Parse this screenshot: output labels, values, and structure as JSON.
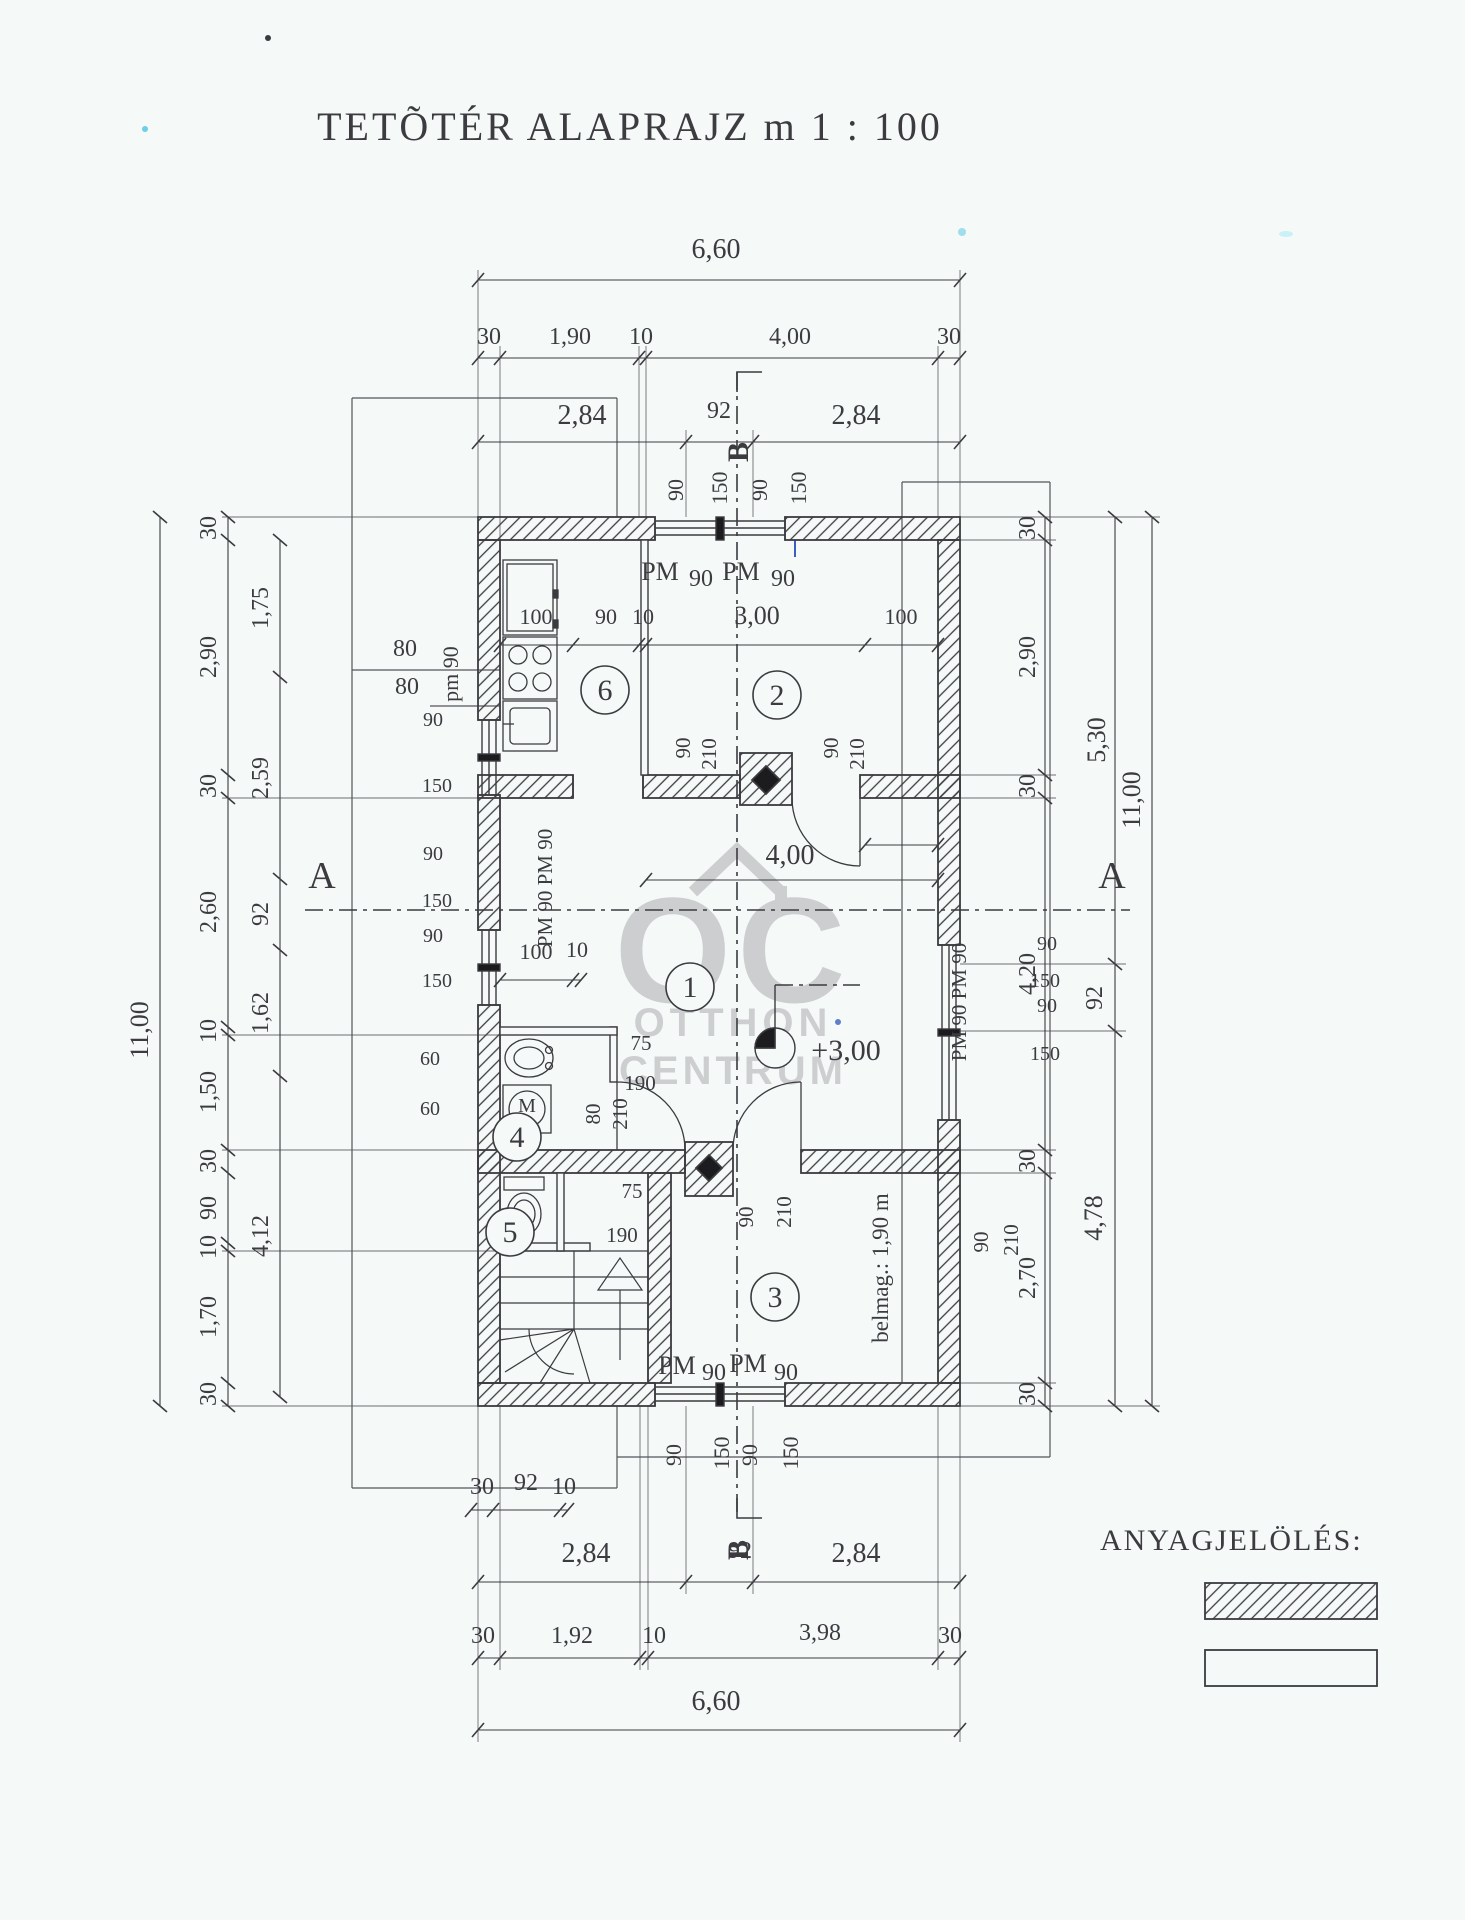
{
  "title": "TETÕTÉR ALAPRAJZ m 1 : 100",
  "legend": {
    "heading": "ANYAGJELÖLÉS:"
  },
  "watermark": {
    "logo": "OC",
    "line1": "OTTHON",
    "line2": "CENTRUM"
  },
  "colors": {
    "ink": "#3b3b40",
    "paper": "#f5f9f8",
    "thin": "#55555a",
    "watermark": "#bcbdc0",
    "blue": "#3a5fc0",
    "cyan": "#49c4e2"
  },
  "scale_text": "m 1 : 100",
  "rooms": [
    {
      "n": "6",
      "x": 605,
      "y": 690
    },
    {
      "n": "2",
      "x": 777,
      "y": 695
    },
    {
      "n": "1",
      "x": 690,
      "y": 987
    },
    {
      "n": "4",
      "x": 517,
      "y": 1137
    },
    {
      "n": "5",
      "x": 510,
      "y": 1232
    },
    {
      "n": "3",
      "x": 775,
      "y": 1297
    }
  ],
  "labels": [
    {
      "t": "6,60",
      "x": 716,
      "y": 258,
      "s": 28
    },
    {
      "t": "30",
      "x": 489,
      "y": 344
    },
    {
      "t": "1,90",
      "x": 570,
      "y": 344
    },
    {
      "t": "10",
      "x": 641,
      "y": 344
    },
    {
      "t": "4,00",
      "x": 790,
      "y": 344
    },
    {
      "t": "30",
      "x": 949,
      "y": 344
    },
    {
      "t": "2,84",
      "x": 582,
      "y": 424,
      "s": 28
    },
    {
      "t": "92",
      "x": 719,
      "y": 418
    },
    {
      "t": "2,84",
      "x": 856,
      "y": 424,
      "s": 28
    },
    {
      "t": "B",
      "x": 748,
      "y": 452,
      "r": -90,
      "s": 30,
      "b": 1
    },
    {
      "t": "90",
      "x": 683,
      "y": 490,
      "r": -90,
      "s": 22
    },
    {
      "t": "150",
      "x": 727,
      "y": 488,
      "r": -90,
      "s": 22
    },
    {
      "t": "90",
      "x": 767,
      "y": 490,
      "r": -90,
      "s": 22
    },
    {
      "t": "150",
      "x": 806,
      "y": 488,
      "r": -90,
      "s": 22
    },
    {
      "t": "PM",
      "x": 660,
      "y": 580,
      "s": 26
    },
    {
      "t": "90",
      "x": 701,
      "y": 586
    },
    {
      "t": "PM",
      "x": 741,
      "y": 580,
      "s": 26
    },
    {
      "t": "90",
      "x": 783,
      "y": 586
    },
    {
      "t": "80",
      "x": 405,
      "y": 656
    },
    {
      "t": "80",
      "x": 407,
      "y": 694
    },
    {
      "t": "pm 90",
      "x": 458,
      "y": 674,
      "r": -90,
      "s": 22
    },
    {
      "t": "100",
      "x": 536,
      "y": 624,
      "s": 22
    },
    {
      "t": "90",
      "x": 606,
      "y": 624,
      "s": 22
    },
    {
      "t": "10",
      "x": 643,
      "y": 624,
      "s": 22
    },
    {
      "t": "3,00",
      "x": 757,
      "y": 624,
      "s": 26
    },
    {
      "t": "100",
      "x": 901,
      "y": 624,
      "s": 22
    },
    {
      "t": "11,00",
      "x": 148,
      "y": 1030,
      "r": -90,
      "s": 26
    },
    {
      "t": "30",
      "x": 216,
      "y": 528,
      "r": -90
    },
    {
      "t": "2,90",
      "x": 216,
      "y": 657,
      "r": -90
    },
    {
      "t": "30",
      "x": 216,
      "y": 786,
      "r": -90
    },
    {
      "t": "2,60",
      "x": 216,
      "y": 912,
      "r": -90
    },
    {
      "t": "10",
      "x": 216,
      "y": 1031,
      "r": -90
    },
    {
      "t": "1,50",
      "x": 216,
      "y": 1092,
      "r": -90
    },
    {
      "t": "30",
      "x": 216,
      "y": 1161,
      "r": -90
    },
    {
      "t": "90",
      "x": 216,
      "y": 1208,
      "r": -90
    },
    {
      "t": "10",
      "x": 216,
      "y": 1247,
      "r": -90
    },
    {
      "t": "1,70",
      "x": 216,
      "y": 1317,
      "r": -90
    },
    {
      "t": "30",
      "x": 216,
      "y": 1394,
      "r": -90
    },
    {
      "t": "1,75",
      "x": 268,
      "y": 608,
      "r": -90
    },
    {
      "t": "2,59",
      "x": 268,
      "y": 778,
      "r": -90
    },
    {
      "t": "92",
      "x": 268,
      "y": 914,
      "r": -90
    },
    {
      "t": "1,62",
      "x": 268,
      "y": 1013,
      "r": -90
    },
    {
      "t": "4,12",
      "x": 268,
      "y": 1236,
      "r": -90
    },
    {
      "t": "90",
      "x": 433,
      "y": 726,
      "s": 20
    },
    {
      "t": "150",
      "x": 437,
      "y": 792,
      "s": 20
    },
    {
      "t": "90",
      "x": 433,
      "y": 860,
      "s": 20
    },
    {
      "t": "150",
      "x": 437,
      "y": 907,
      "s": 20
    },
    {
      "t": "90",
      "x": 433,
      "y": 942,
      "s": 20
    },
    {
      "t": "150",
      "x": 437,
      "y": 987,
      "s": 20
    },
    {
      "t": "60",
      "x": 430,
      "y": 1065,
      "s": 20
    },
    {
      "t": "60",
      "x": 430,
      "y": 1115,
      "s": 20
    },
    {
      "t": "PM 90 PM 90",
      "x": 552,
      "y": 888,
      "r": -90,
      "s": 21
    },
    {
      "t": "100",
      "x": 536,
      "y": 959,
      "s": 22
    },
    {
      "t": "10",
      "x": 577,
      "y": 957,
      "s": 22
    },
    {
      "t": "A",
      "x": 322,
      "y": 888,
      "s": 38
    },
    {
      "t": "A",
      "x": 1112,
      "y": 888,
      "s": 38
    },
    {
      "t": "4,00",
      "x": 790,
      "y": 864,
      "s": 28
    },
    {
      "t": "90",
      "x": 690,
      "y": 748,
      "r": -90,
      "s": 21
    },
    {
      "t": "210",
      "x": 716,
      "y": 754,
      "r": -90,
      "s": 21
    },
    {
      "t": "90",
      "x": 838,
      "y": 748,
      "r": -90,
      "s": 21
    },
    {
      "t": "210",
      "x": 864,
      "y": 754,
      "r": -90,
      "s": 21
    },
    {
      "t": "+3,00",
      "x": 846,
      "y": 1060,
      "s": 30
    },
    {
      "t": "75",
      "x": 641,
      "y": 1050,
      "s": 21
    },
    {
      "t": "190",
      "x": 640,
      "y": 1090,
      "s": 21
    },
    {
      "t": "80",
      "x": 600,
      "y": 1114,
      "r": -90,
      "s": 21
    },
    {
      "t": "210",
      "x": 627,
      "y": 1114,
      "r": -90,
      "s": 21
    },
    {
      "t": "90",
      "x": 753,
      "y": 1217,
      "r": -90,
      "s": 21
    },
    {
      "t": "210",
      "x": 791,
      "y": 1212,
      "r": -90,
      "s": 21
    },
    {
      "t": "75",
      "x": 632,
      "y": 1198,
      "s": 21
    },
    {
      "t": "190",
      "x": 622,
      "y": 1242,
      "s": 21
    },
    {
      "t": "M",
      "x": 527,
      "y": 1112,
      "s": 20
    },
    {
      "t": "belmag.: 1,90 m",
      "x": 888,
      "y": 1268,
      "r": -90,
      "s": 23
    },
    {
      "t": "PM 90 PM 90",
      "x": 966,
      "y": 1002,
      "r": -90,
      "s": 21
    },
    {
      "t": "90",
      "x": 1047,
      "y": 950,
      "s": 20
    },
    {
      "t": "150",
      "x": 1045,
      "y": 987,
      "s": 20
    },
    {
      "t": "90",
      "x": 1047,
      "y": 1012,
      "s": 20
    },
    {
      "t": "150",
      "x": 1045,
      "y": 1060,
      "s": 20
    },
    {
      "t": "90",
      "x": 988,
      "y": 1242,
      "r": -90,
      "s": 21
    },
    {
      "t": "210",
      "x": 1018,
      "y": 1240,
      "r": -90,
      "s": 21
    },
    {
      "t": "30",
      "x": 1035,
      "y": 528,
      "r": -90
    },
    {
      "t": "2,90",
      "x": 1035,
      "y": 657,
      "r": -90
    },
    {
      "t": "30",
      "x": 1035,
      "y": 786,
      "r": -90
    },
    {
      "t": "4,20",
      "x": 1035,
      "y": 974,
      "r": -90
    },
    {
      "t": "30",
      "x": 1035,
      "y": 1161,
      "r": -90
    },
    {
      "t": "2,70",
      "x": 1035,
      "y": 1278,
      "r": -90
    },
    {
      "t": "30",
      "x": 1035,
      "y": 1394,
      "r": -90
    },
    {
      "t": "5,30",
      "x": 1105,
      "y": 740,
      "r": -90,
      "s": 26
    },
    {
      "t": "92",
      "x": 1102,
      "y": 998,
      "r": -90
    },
    {
      "t": "4,78",
      "x": 1102,
      "y": 1218,
      "r": -90,
      "s": 26
    },
    {
      "t": "11,00",
      "x": 1140,
      "y": 800,
      "r": -90,
      "s": 26
    },
    {
      "t": "PM",
      "x": 677,
      "y": 1374,
      "s": 26
    },
    {
      "t": "90",
      "x": 714,
      "y": 1380
    },
    {
      "t": "PM",
      "x": 748,
      "y": 1372,
      "s": 26
    },
    {
      "t": "90",
      "x": 786,
      "y": 1380
    },
    {
      "t": "90",
      "x": 681,
      "y": 1455,
      "r": -90,
      "s": 22
    },
    {
      "t": "150",
      "x": 729,
      "y": 1453,
      "r": -90,
      "s": 22
    },
    {
      "t": "90",
      "x": 757,
      "y": 1455,
      "r": -90,
      "s": 22
    },
    {
      "t": "150",
      "x": 798,
      "y": 1453,
      "r": -90,
      "s": 22
    },
    {
      "t": "30",
      "x": 482,
      "y": 1494
    },
    {
      "t": "92",
      "x": 526,
      "y": 1490
    },
    {
      "t": "10",
      "x": 564,
      "y": 1494
    },
    {
      "t": "B",
      "x": 748,
      "y": 1550,
      "r": -90,
      "s": 30,
      "b": 1
    },
    {
      "t": "2,84",
      "x": 586,
      "y": 1562,
      "s": 28
    },
    {
      "t": "92",
      "x": 740,
      "y": 1558
    },
    {
      "t": "2,84",
      "x": 856,
      "y": 1562,
      "s": 28
    },
    {
      "t": "30",
      "x": 483,
      "y": 1643
    },
    {
      "t": "1,92",
      "x": 572,
      "y": 1643
    },
    {
      "t": "10",
      "x": 654,
      "y": 1643
    },
    {
      "t": "3,98",
      "x": 820,
      "y": 1640
    },
    {
      "t": "30",
      "x": 950,
      "y": 1643
    },
    {
      "t": "6,60",
      "x": 716,
      "y": 1710,
      "s": 28
    }
  ],
  "chains": [
    {
      "o": "h",
      "p": 280,
      "a": 478,
      "b": 960,
      "t": [
        478,
        960
      ]
    },
    {
      "o": "h",
      "p": 358,
      "a": 478,
      "b": 960,
      "t": [
        478,
        500,
        639,
        646,
        938,
        960
      ]
    },
    {
      "o": "h",
      "p": 442,
      "a": 478,
      "b": 960,
      "t": [
        478,
        686,
        753,
        960
      ]
    },
    {
      "o": "h",
      "p": 645,
      "a": 500,
      "b": 938,
      "t": [
        500,
        573,
        639,
        646,
        865,
        938
      ]
    },
    {
      "o": "h",
      "p": 880,
      "a": 646,
      "b": 938,
      "t": [
        646,
        938
      ]
    },
    {
      "o": "h",
      "p": 980,
      "a": 500,
      "b": 581,
      "t": [
        500,
        573,
        581
      ]
    },
    {
      "o": "h",
      "p": 845,
      "a": 865,
      "b": 938,
      "t": [
        865,
        938
      ]
    },
    {
      "o": "h",
      "p": 1510,
      "a": 471,
      "b": 568,
      "t": [
        471,
        493,
        560,
        568
      ]
    },
    {
      "o": "h",
      "p": 1582,
      "a": 478,
      "b": 960,
      "t": [
        478,
        686,
        753,
        960
      ]
    },
    {
      "o": "h",
      "p": 1658,
      "a": 478,
      "b": 960,
      "t": [
        478,
        500,
        640,
        648,
        938,
        960
      ]
    },
    {
      "o": "h",
      "p": 1730,
      "a": 478,
      "b": 960,
      "t": [
        478,
        960
      ]
    },
    {
      "o": "v",
      "p": 160,
      "a": 517,
      "b": 1406,
      "t": [
        517,
        1406
      ]
    },
    {
      "o": "v",
      "p": 228,
      "a": 517,
      "b": 1406,
      "t": [
        517,
        540,
        775,
        798,
        1027,
        1035,
        1150,
        1173,
        1243,
        1251,
        1383,
        1406
      ]
    },
    {
      "o": "v",
      "p": 280,
      "a": 540,
      "b": 1397,
      "t": [
        540,
        677,
        879,
        950,
        1076,
        1397
      ]
    },
    {
      "o": "v",
      "p": 1045,
      "a": 517,
      "b": 1406,
      "t": [
        517,
        540,
        775,
        798,
        1150,
        1173,
        1383,
        1406
      ]
    },
    {
      "o": "v",
      "p": 1115,
      "a": 517,
      "b": 1406,
      "t": [
        517,
        964,
        1031,
        1406
      ]
    },
    {
      "o": "v",
      "p": 1152,
      "a": 517,
      "b": 1406,
      "t": [
        517,
        1406
      ]
    }
  ]
}
